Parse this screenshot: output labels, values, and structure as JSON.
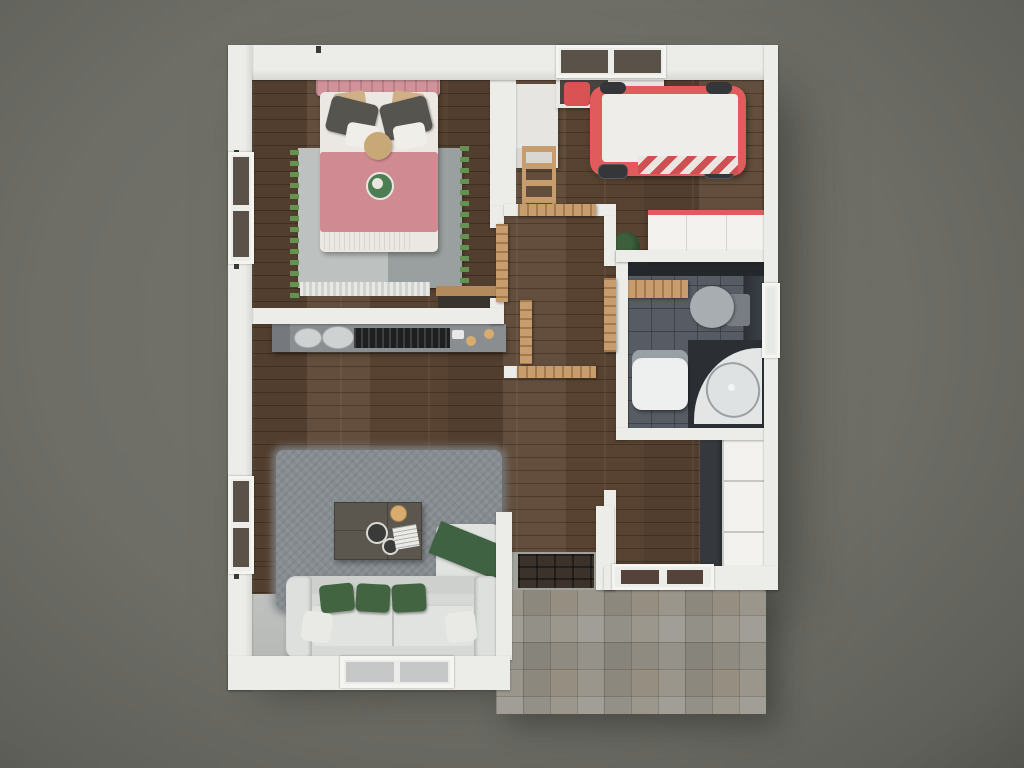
{
  "scene": {
    "type": "3d-floorplan-render",
    "view": "top-down",
    "description": "Photorealistic top-down 3D render of a small single-storey house floor plan on a plain dark ground, with white walls, wood flooring, a stone patio at the lower right and furnished rooms."
  },
  "rooms": [
    {
      "id": "bedroom",
      "position": "top-left",
      "floor": "wood"
    },
    {
      "id": "kids-room",
      "position": "top-right",
      "floor": "wood"
    },
    {
      "id": "bathroom",
      "position": "middle-right",
      "floor": "dark-tile"
    },
    {
      "id": "hallway",
      "position": "center",
      "floor": "wood"
    },
    {
      "id": "living-kitchen",
      "position": "bottom-left",
      "floor": "wood-and-concrete"
    },
    {
      "id": "entry-hall",
      "position": "right",
      "floor": "wood"
    },
    {
      "id": "patio",
      "position": "bottom-right-outside",
      "floor": "stone-tile"
    }
  ],
  "furniture": {
    "bedroom": [
      "double-bed-pink",
      "two-dark-pillows",
      "two-beige-pillows",
      "round-cushion",
      "green-plate-decor",
      "two-tone-rug-with-green-fringe",
      "wood-dresser"
    ],
    "kids_room": [
      "red-race-car-bed",
      "white-desk",
      "wood-ladder-chair",
      "window-desk-with-red-chair",
      "white-wardrobe-red-trim",
      "potted-plant"
    ],
    "bathroom": [
      "toilet",
      "corner-bathtub",
      "washbasin",
      "wood-towel-shelf",
      "dark-glass-shower-panel"
    ],
    "living_kitchen": [
      "kitchen-counter-with-sink-and-stove",
      "range-hood",
      "gray-shag-rug",
      "coffee-table",
      "gold-bowl",
      "two-plates",
      "white-magazine",
      "armchair-with-green-throw",
      "three-seat-sofa",
      "three-green-pillows",
      "two-white-pillows"
    ],
    "entry_hall": [
      "white-closet-three-sections",
      "dark-wall-panel",
      "door-mat"
    ],
    "hallway": [
      "open-door-bedroom",
      "open-door-kids-room",
      "open-door-bathroom",
      "open-door-living-1",
      "open-door-living-2"
    ]
  },
  "openings": {
    "windows": [
      "bedroom-left-wall",
      "living-left-wall",
      "living-bottom-wall",
      "kids-top-wall",
      "bathroom-right-wall"
    ],
    "doors": [
      "front-door-bottom-right",
      "patio-opening"
    ]
  },
  "colors": {
    "ground-hi": "#74746c",
    "ground": "#6e6e67",
    "ground-lo": "#60605a",
    "ground-edge": "#54544e",
    "wall": "#ececE9",
    "wall-shade": "#d8d8d4",
    "wood": "#5b4533",
    "doorwood": "#c79d6e",
    "tile": "#575b63",
    "patio": "#97948b",
    "gray-floor": "#b7b9b7",
    "porch": "#a2a29d",
    "rug-living": "#868c90",
    "rugL": "#bdc1c0",
    "rugD": "#9aa09f",
    "fringe": "#639251",
    "bedpink": "#d2929a",
    "blanket": "#cf8b91",
    "white-soft": "#ebe8e3",
    "pillow-dark": "#56544f",
    "pillow-beige": "#cfb088",
    "cushion-tan": "#c9a878",
    "plate-green": "#4d7d55",
    "car": "#e25b5c",
    "wheel": "#35363a",
    "sofa": "#d6d9d5",
    "sofa-light": "#e0e3df",
    "greenp": "#426441",
    "green-throw": "#3f6243",
    "table": "#5c574e",
    "gold": "#d8ac6f",
    "counter": "#8a8e91",
    "stove": "#1d1f21",
    "hood": "#3f4245",
    "dark-panel": "#35393e",
    "mat": "#3b332b",
    "closet": "#f3f2ef",
    "toilet": "#a8adb1",
    "tank": "#787d83",
    "tub-dark": "#2b2f34",
    "fixture": "#eef0f0",
    "pane-dark": "#5a5148",
    "pane-door": "#55433a",
    "pane-light": "#c6c8c7",
    "plant": "#2f4c31"
  }
}
